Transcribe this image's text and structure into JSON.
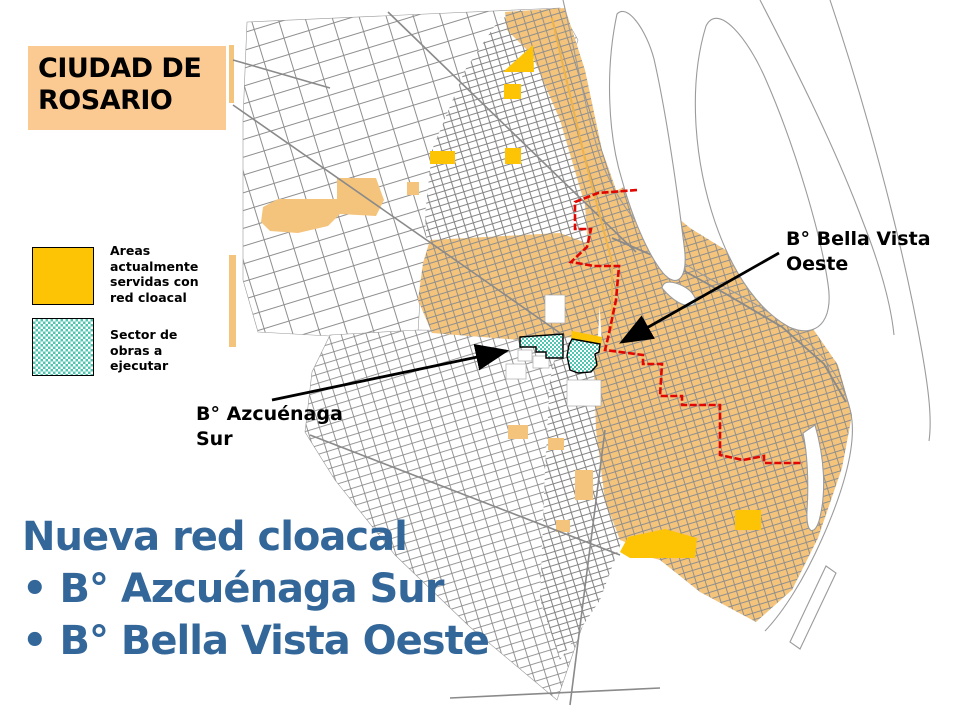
{
  "colors": {
    "page-bg": "#FFFFFF",
    "title-box-bg": "#FBCA92",
    "heading-blue": "#336699",
    "label-black": "#000000",
    "served-gold": "#FCC405",
    "served-orange": "#F4C47C",
    "teal": "#4EC6B0",
    "boundary-red": "#E10600",
    "street-gray": "#8E8E8E",
    "river-gray": "#9B9B9B"
  },
  "title_box": {
    "text": "CIUDAD DE ROSARIO"
  },
  "legend": {
    "items": [
      {
        "id": "served",
        "label": "Areas actualmente servidas con red cloacal"
      },
      {
        "id": "works",
        "label": "Sector de obras a ejecutar"
      }
    ]
  },
  "map": {
    "labels": [
      {
        "id": "bella-vista",
        "text": "B° Bella Vista Oeste"
      },
      {
        "id": "azcuenaga",
        "text": "B° Azcuénaga Sur"
      }
    ]
  },
  "heading": {
    "line1": "Nueva red cloacal",
    "line2": "• B° Azcuénaga Sur",
    "line3": "• B° Bella Vista Oeste"
  }
}
